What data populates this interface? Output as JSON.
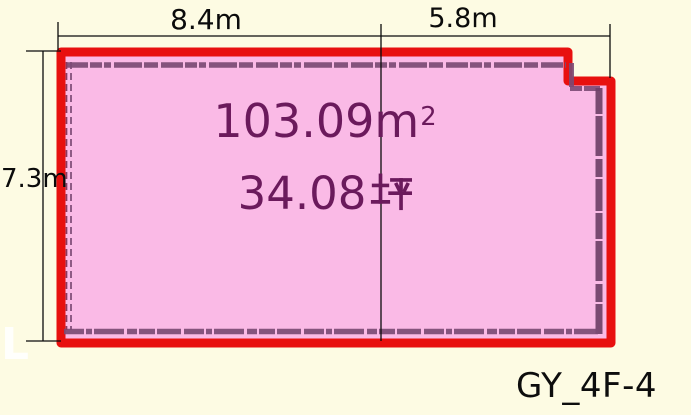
{
  "plan": {
    "id_label": "GY_4F-4",
    "watermark": "L"
  },
  "dimensions": {
    "top_left_width": "8.4m",
    "top_right_width": "5.8m",
    "left_height": "7.3m"
  },
  "room": {
    "area_value": "103.09",
    "area_unit_base": "m",
    "area_unit_sup": "2",
    "area_label": "103.09m²",
    "tsubo_value": "34.08",
    "tsubo_unit": "坪",
    "tsubo_label": "34.08坪"
  },
  "colors": {
    "background": "#FDFBE3",
    "room_fill": "#FABAE6",
    "outline_red": "#E8100F",
    "wall_hatch_purple": "#7B4A74",
    "area_text_purple": "#6B1A5C",
    "dimension_text": "#0B0B0B"
  }
}
